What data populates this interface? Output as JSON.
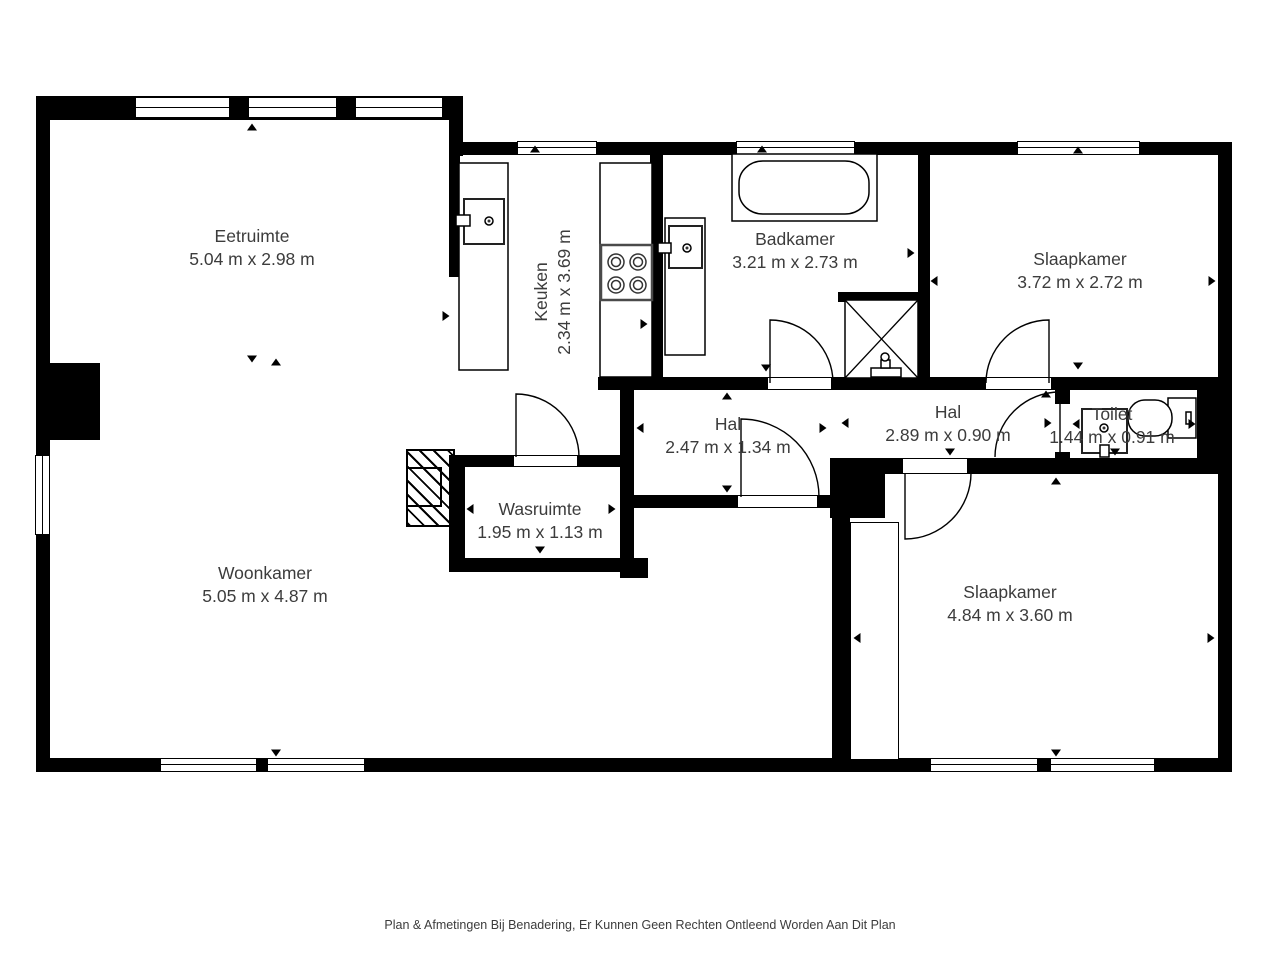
{
  "rooms": [
    {
      "id": "eetruimte",
      "name": "Eetruimte",
      "dimensions": "5.04 m x 2.98 m"
    },
    {
      "id": "keuken",
      "name": "Keuken",
      "dimensions": "2.34 m x 3.69 m"
    },
    {
      "id": "badkamer",
      "name": "Badkamer",
      "dimensions": "3.21 m x 2.73 m"
    },
    {
      "id": "slaapkamer-1",
      "name": "Slaapkamer",
      "dimensions": "3.72 m x 2.72 m"
    },
    {
      "id": "hal-1",
      "name": "Hal",
      "dimensions": "2.47 m x 1.34 m"
    },
    {
      "id": "hal-2",
      "name": "Hal",
      "dimensions": "2.89 m x 0.90 m"
    },
    {
      "id": "toilet",
      "name": "Toilet",
      "dimensions": "1.44 m x 0.91 m"
    },
    {
      "id": "wasruimte",
      "name": "Wasruimte",
      "dimensions": "1.95 m x 1.13 m"
    },
    {
      "id": "woonkamer",
      "name": "Woonkamer",
      "dimensions": "5.05 m x 4.87 m"
    },
    {
      "id": "slaapkamer-2",
      "name": "Slaapkamer",
      "dimensions": "4.84 m x 3.60 m"
    }
  ],
  "footer": {
    "disclaimer": "Plan & Afmetingen Bij Benadering, Er Kunnen Geen Rechten Ontleend Worden Aan Dit Plan"
  },
  "colors": {
    "wall": "#000000",
    "text": "#3c3c3c",
    "background": "#ffffff"
  }
}
